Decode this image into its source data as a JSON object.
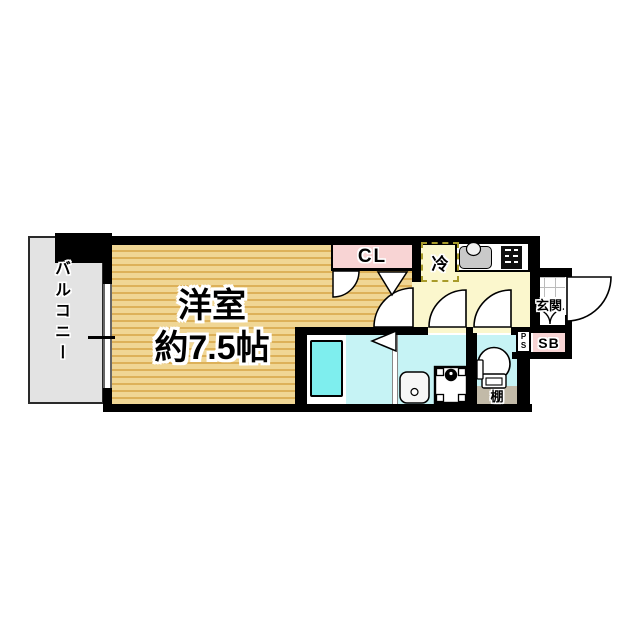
{
  "plan": {
    "title": "apartment-floor-plan",
    "labels": {
      "balcony": "バルコニー",
      "room_line1": "洋室",
      "room_line2": "約7.5帖",
      "closet": "CL",
      "fridge": "冷",
      "entrance": "玄関",
      "shoebox": "SB",
      "pipe_space": "P\nS",
      "shelf": "棚"
    },
    "colors": {
      "wall": "#000000",
      "room_light": "#f0d694",
      "room_dark": "#ddb159",
      "kitchen_yellow": "#fbf7cd",
      "wet_cyan": "#c6f3f5",
      "bathtub_cyan": "#7eeeee",
      "closet_pink": "#f8d4d4",
      "balcony_gray": "#e3e3e3",
      "shelf_tan": "#c2baa8",
      "fridge_dash": "#a89b2a"
    }
  }
}
